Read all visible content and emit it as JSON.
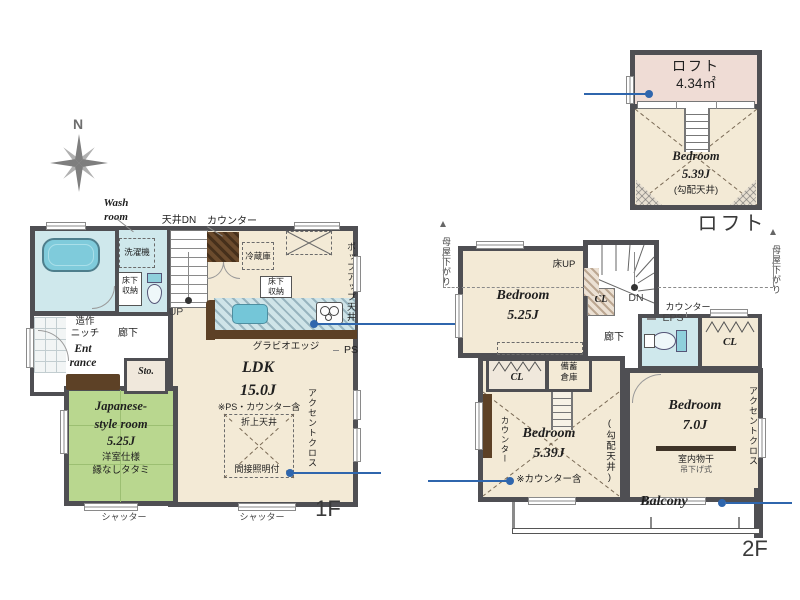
{
  "meta": {
    "type": "floor-plan",
    "floors": [
      "1F",
      "2F",
      "ロフト"
    ]
  },
  "palette": {
    "wall": "#4f4f53",
    "floor": "#f3ead6",
    "tatami": "#b9d78f",
    "water": "#cfe8ec",
    "loft_floor": "#efdcd5",
    "callout_blue": "#2f66ad",
    "wood": "#5d4126"
  },
  "compass": {
    "north": "N"
  },
  "f1": {
    "caption": "1F",
    "wash_room": "Wash\nroom",
    "ceiling_dn": "天井DN",
    "counter_top": "カウンター",
    "bathroom": "Bathroom",
    "washer": "洗濯機",
    "underfloor": "床下\n収納",
    "fridge": "冷蔵庫",
    "popup_ceiling": "ポップアップ天井",
    "ps": "PS",
    "gravio_edge": "グラビオエッジ",
    "niche": "造作\nニッチ",
    "entrance": "Ent\nrance",
    "hallway": "廊下",
    "up": "UP",
    "storage": "Sto.",
    "ldk": "LDK\n15.0J",
    "ldk_note": "※PS・カウンター含",
    "folded_ceiling": "折上天井",
    "indirect_lighting": "間接照明付",
    "accent_cloth": "アクセントクロス",
    "japanese_room": "Japanese-\nstyle room\n5.25J",
    "jroom_note1": "洋室仕様",
    "jroom_note2": "縁なしタタミ",
    "shutter": "シャッター"
  },
  "loft": {
    "caption": "ロフト",
    "name": "ロフト",
    "area": "4.34㎡",
    "bedroom": "Bedroom\n5.39J",
    "note": "(勾配天井)"
  },
  "f2": {
    "caption": "2F",
    "moya_sagari": "母屋下がり",
    "bedroom_525": "Bedroom\n5.25J",
    "floor_up": "床UP",
    "cl": "CL",
    "dn": "DN",
    "eps": "EPS",
    "counter": "カウンター",
    "hallway": "廊下",
    "stock_storage": "備蓄\n倉庫",
    "bedroom_539": "Bedroom\n5.39J",
    "counter_note": "※カウンター含",
    "sloped_ceiling": "(勾配天井)",
    "bedroom_70": "Bedroom\n7.0J",
    "indoor_drying": "室内物干",
    "hanging_type": "吊下げ式",
    "accent_cloth": "アクセントクロス",
    "balcony": "Balcony"
  }
}
